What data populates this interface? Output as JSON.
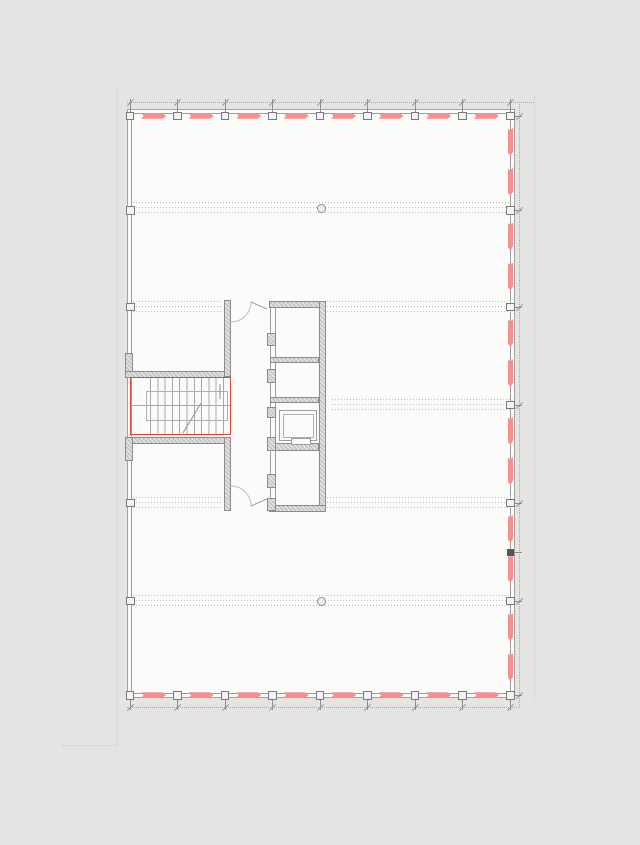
{
  "scene": {
    "width": 640,
    "height": 845,
    "background": "#e4e4e3",
    "paper_color": "#fbfbfa"
  },
  "colors": {
    "outer_line": "#a3a3a3",
    "inner_line": "#9d9d9d",
    "square_border": "#7a7a7a",
    "square_fill": "#f3f3f3",
    "facade_red": "#f69090",
    "stair_red": "#e0463c",
    "wall_fill": "#e0e0e0",
    "wall_border": "#8c8c8c",
    "hatch": "rgba(120,120,120,0.35)",
    "band_dot": "#c5c5c5",
    "dim_line": "#a9a9a9",
    "tick": "#8f8f8f",
    "faint": "#cccccc",
    "thin": "#9e9e9e",
    "tread": "#a8a8a8",
    "handrail": "#b0b0b0",
    "dark_marker": "#565656",
    "door_arc": "#bdbdbd",
    "circle_fill": "#efefef"
  },
  "plan": {
    "outer": {
      "x": 127,
      "y": 109,
      "w": 388,
      "h": 589
    },
    "inner": {
      "x": 131,
      "y": 113,
      "w": 380,
      "h": 581
    },
    "columns_x": [
      130,
      177.5,
      225,
      272.5,
      320,
      367.5,
      415,
      462.5,
      510.5
    ],
    "rows_y": [
      116,
      210.5,
      307,
      405,
      503,
      601,
      695.5
    ],
    "left_col_rows": [
      210.5,
      307,
      503,
      601
    ],
    "top_edge_y": 116,
    "bottom_edge_y": 695,
    "right_edge_x": 510.5,
    "left_edge_x": 130.5,
    "square_size": 8.5,
    "dash": {
      "length": 25,
      "thickness": 5.5,
      "v_offsets": [
        12,
        52
      ],
      "v_length": 28
    },
    "band_height": 17,
    "bands": [
      {
        "y": 208,
        "x1": 132,
        "x2": 511
      },
      {
        "y": 307,
        "x1": 132,
        "x2": 223
      },
      {
        "y": 307,
        "x1": 326,
        "x2": 511
      },
      {
        "y": 405,
        "x1": 331,
        "x2": 511
      },
      {
        "y": 503,
        "x1": 132,
        "x2": 223
      },
      {
        "y": 503,
        "x1": 326,
        "x2": 511
      },
      {
        "y": 601,
        "x1": 132,
        "x2": 511
      }
    ],
    "circles": [
      {
        "x": 321,
        "y": 208.5,
        "r": 4.5
      },
      {
        "x": 321,
        "y": 601.5,
        "r": 4.5
      }
    ],
    "dark_marker": {
      "x": 506.5,
      "y": 549,
      "w": 7,
      "h": 6.5
    }
  },
  "dims": {
    "top": {
      "y": 102,
      "x1": 127,
      "x2": 534
    },
    "bottom": {
      "y": 707,
      "x1": 127,
      "x2": 519
    },
    "right": {
      "x": 519,
      "y1": 102,
      "y2": 707
    },
    "tick_len": 12
  },
  "refs": [
    {
      "x1": 117,
      "y1": 88,
      "x2": 117,
      "y2": 745
    },
    {
      "x1": 62,
      "y1": 745,
      "x2": 118,
      "y2": 745
    },
    {
      "x1": 534,
      "y1": 96,
      "x2": 534,
      "y2": 700
    }
  ],
  "core": {
    "walls": [
      {
        "x": 125,
        "y": 353,
        "w": 8,
        "h": 24
      },
      {
        "x": 125,
        "y": 371,
        "w": 106,
        "h": 6.5
      },
      {
        "x": 125,
        "y": 437,
        "w": 106,
        "h": 6.5
      },
      {
        "x": 125,
        "y": 437,
        "w": 8,
        "h": 24
      },
      {
        "x": 224,
        "y": 300,
        "w": 7,
        "h": 77
      },
      {
        "x": 224,
        "y": 437,
        "w": 7,
        "h": 74
      },
      {
        "x": 269,
        "y": 301,
        "w": 57,
        "h": 7
      },
      {
        "x": 319,
        "y": 301,
        "w": 7,
        "h": 211
      },
      {
        "x": 269,
        "y": 505,
        "w": 57,
        "h": 7
      },
      {
        "x": 270,
        "y": 357,
        "w": 49,
        "h": 6
      },
      {
        "x": 270,
        "y": 397,
        "w": 49,
        "h": 6
      },
      {
        "x": 270,
        "y": 443,
        "w": 49,
        "h": 8
      },
      {
        "x": 267,
        "y": 333,
        "w": 9,
        "h": 13
      },
      {
        "x": 267,
        "y": 369,
        "w": 9,
        "h": 14
      },
      {
        "x": 267,
        "y": 407,
        "w": 9,
        "h": 11
      },
      {
        "x": 267,
        "y": 437,
        "w": 9,
        "h": 14
      },
      {
        "x": 267,
        "y": 474,
        "w": 9,
        "h": 14
      },
      {
        "x": 267,
        "y": 498,
        "w": 9,
        "h": 13
      }
    ],
    "shaft_door_lines": [
      {
        "x": 270,
        "y1": 308,
        "y2": 505
      },
      {
        "x": 275,
        "y1": 308,
        "y2": 505
      }
    ],
    "stair": {
      "rect": {
        "x": 130,
        "y": 377,
        "w": 101,
        "h": 58
      },
      "treads": {
        "x": 150,
        "y": 378,
        "w": 79,
        "h": 56,
        "step": 7.3
      },
      "mid_line_y": 405,
      "handrail": {
        "x": 146,
        "y": 391,
        "w": 82,
        "h": 30
      }
    },
    "car": {
      "outer": {
        "x": 279,
        "y": 410,
        "w": 38,
        "h": 31
      },
      "inner": {
        "x": 282.5,
        "y": 413.5,
        "w": 31,
        "h": 24
      },
      "sill": {
        "x": 291,
        "y": 438,
        "w": 20,
        "h": 6.5
      }
    },
    "paths": [
      {
        "name": "door-arc-top",
        "d": "M231,322 A20 20 0 0 0 251,302",
        "color": "door_arc",
        "w": 1
      },
      {
        "name": "door-leaf-top",
        "d": "M251,302 L267,309",
        "color": "thin",
        "w": 1
      },
      {
        "name": "door-arc-bottom",
        "d": "M231,486 A20 20 0 0 1 251,506",
        "color": "door_arc",
        "w": 1
      },
      {
        "name": "door-leaf-bottom",
        "d": "M251,506 L267,499",
        "color": "thin",
        "w": 1
      },
      {
        "name": "stair-walk-line",
        "d": "M183,433 L201,403",
        "color": "thin",
        "w": 1.2
      },
      {
        "name": "stair-walk-tick",
        "d": "M220,384 L220,399",
        "color": "thin",
        "w": 1.2
      }
    ]
  }
}
